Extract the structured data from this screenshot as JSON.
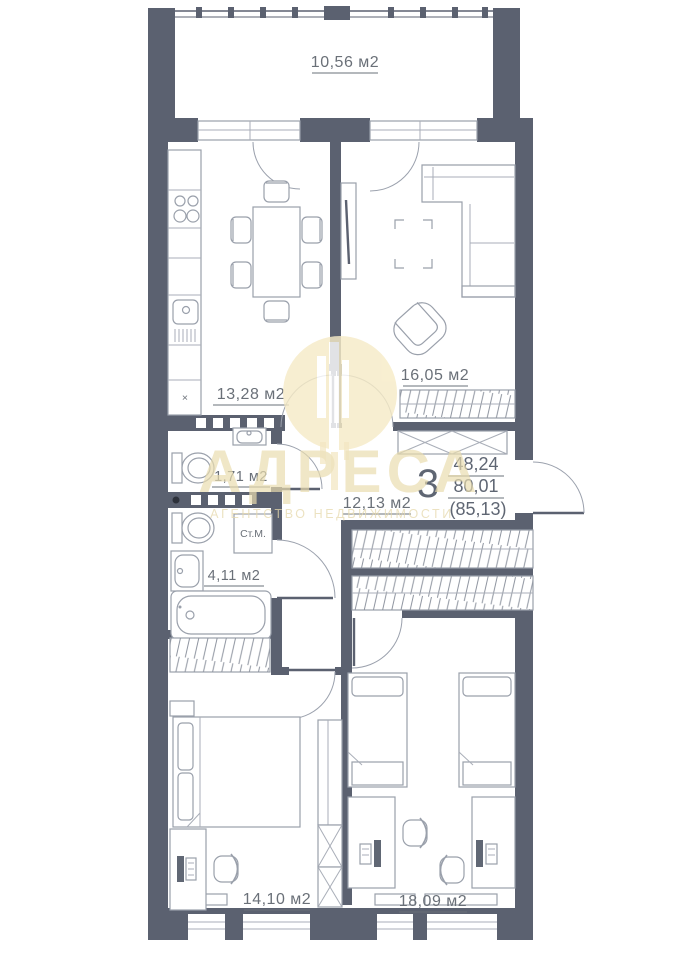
{
  "floorplan": {
    "rooms": [
      {
        "area_label": "10,56 м2"
      },
      {
        "area_label": "13,28 м2"
      },
      {
        "area_label": "16,05 м2"
      },
      {
        "area_label": "1,71 м2"
      },
      {
        "area_label": "12,13 м2"
      },
      {
        "area_label": "4,11 м2"
      },
      {
        "area_label": "14,10 м2"
      },
      {
        "area_label": "18,09 м2"
      }
    ],
    "summary": {
      "rooms_count": "3",
      "living_area": "48,24",
      "apartment_area": "80,01",
      "total_area": "(85,13)"
    },
    "appliance_labels": {
      "washing_machine": "Ст.М.",
      "kitchen_niche_mark": "×"
    },
    "watermark": {
      "title": "АДРЕСА",
      "subtitle": "АГЕНТСТВО НЕДВИЖИМОСТИ"
    },
    "colors": {
      "wall": "#5b6170",
      "furniture_line": "#9aa0ab",
      "label_text": "#6a7078",
      "watermark_accent": "#e9dcae"
    }
  }
}
